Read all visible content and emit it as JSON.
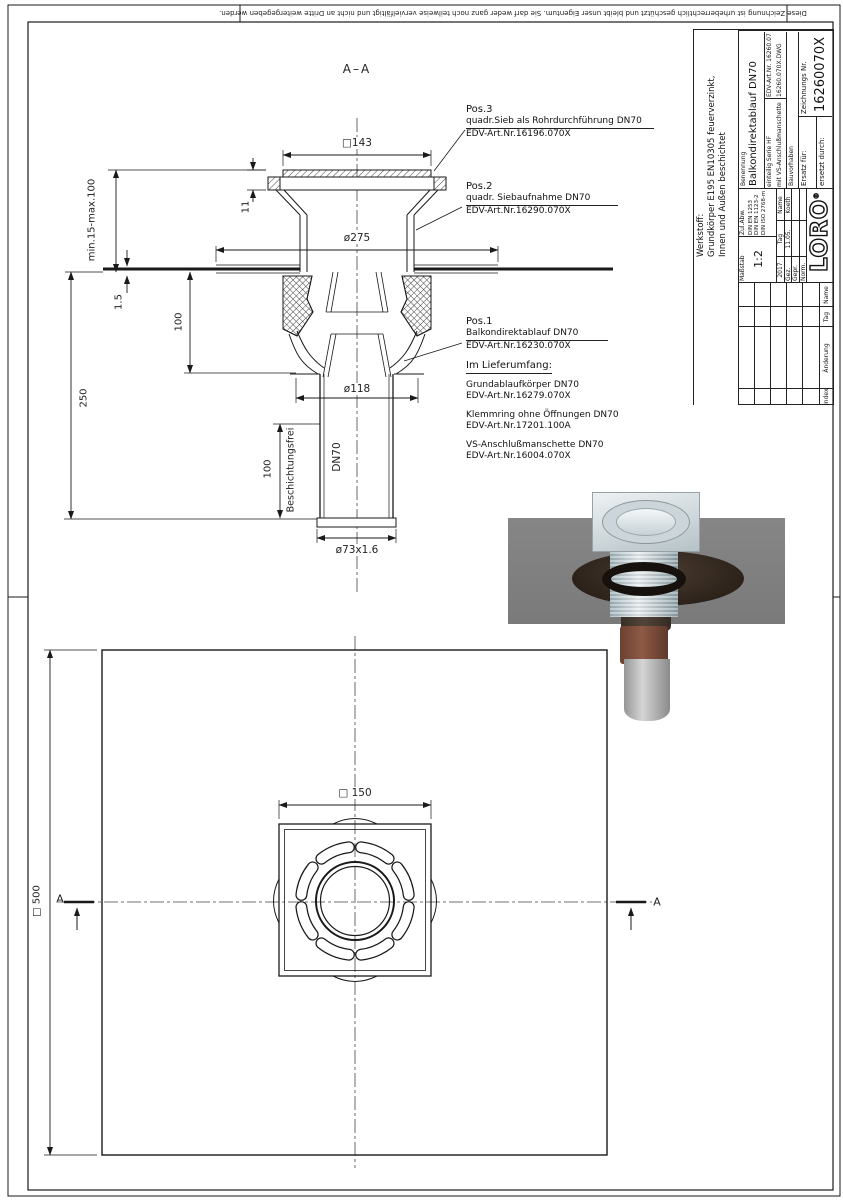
{
  "sheet": {
    "copyright": "Diese Zeichnung ist urheberrechtlich geschützt und bleibt unser Eigentum. Sie darf weder ganz noch teilweise vervielfältigt und nicht an Dritte weitergegeben werden.",
    "section_label": "A–A",
    "section_marker": "A"
  },
  "dims": {
    "square_top": "□143",
    "frame_h": "11",
    "flange_dia": "ø275",
    "depth": "min.15-max.100",
    "membrane": "1.5",
    "body_h": "100",
    "total_h": "250",
    "outlet": "ø118",
    "coatfree_len": "100",
    "coatfree": "Beschichtungsfrei",
    "pipe": "DN70",
    "pipe_od": "ø73x1.6",
    "plan_grate": "□ 150",
    "plan_membrane": "□ 500"
  },
  "callouts": {
    "pos3": {
      "id": "Pos.3",
      "desc": "quadr.Sieb als Rohrdurchführung DN70",
      "edv": "EDV-Art.Nr.16196.070X"
    },
    "pos2": {
      "id": "Pos.2",
      "desc": "quadr. Siebaufnahme DN70",
      "edv": "EDV-Art.Nr.16290.070X"
    },
    "pos1": {
      "id": "Pos.1",
      "desc": "Balkondirektablauf DN70",
      "edv": "EDV-Art.Nr.16230.070X"
    },
    "scope_title": "Im Lieferumfang:",
    "scope": [
      {
        "name": "Grundablaufkörper DN70",
        "edv": "EDV-Art.Nr.16279.070X"
      },
      {
        "name": "Klemmring ohne Öffnungen DN70",
        "edv": "EDV-Art.Nr.17201.100A"
      },
      {
        "name": "VS-Anschlußmanschette DN70",
        "edv": "EDV-Art.Nr.16004.070X"
      }
    ]
  },
  "titleblock": {
    "werkstoff_label": "Werkstoff:",
    "werkstoff_1": "Grundkörper E195 EN10305 feuerverzinkt,",
    "werkstoff_2": "Innen und Außen beschichtet",
    "masstab_label": "Maßstab",
    "masstab": "1:2",
    "zulabw_label": "Zul.Abw.",
    "zulabw_1": "DIN EN 1253",
    "zulabw_2": "DIN EN 1123-2",
    "zulabw_3": "DIN ISO 2768-m",
    "year": "2017",
    "col_tag": "Tag",
    "col_name": "Name",
    "row_gez": "Gez.",
    "gez_tag": "11.05.",
    "gez_name": "Koeth",
    "row_gepr": "Gepr.",
    "row_norm": "Norm.",
    "logo": "LORO",
    "logo_reg": "®",
    "benennung_label": "Benennung",
    "benennung": "Balkondirektablauf DN70",
    "variant_1": "einteilig Serie HF",
    "variant_2": "mit VS-Anschlußmanschette",
    "edv": "EDV-Art.Nr. 16260.070X",
    "file": "16260.070X.DWG",
    "bauvorhaben": "Bauvorhaben",
    "zeichnung_label": "Zeichnungs Nr.",
    "zeichnung_nr": "16260070X",
    "ersatz": "Ersatz für:",
    "ersetzt": "ersetzt durch:",
    "rev_index": "Index",
    "rev_aenderung": "Änderung",
    "rev_tag": "Tag",
    "rev_name": "Name"
  }
}
